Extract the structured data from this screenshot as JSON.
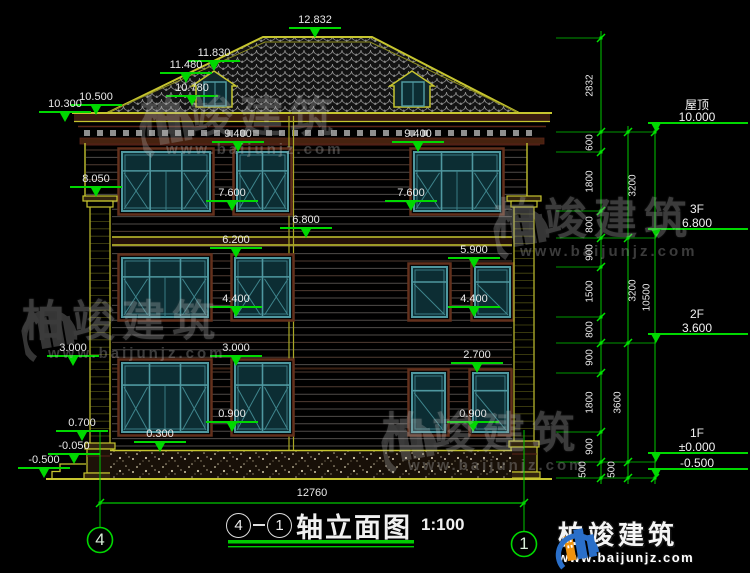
{
  "colors": {
    "green": "#00d800",
    "yellow": "#c6c52f",
    "teal": "#4f98a0",
    "trim_brown": "#63301c",
    "white": "#e9e9e9",
    "logo_blue": "#2a6fc9",
    "logo_orange": "#f0920e",
    "watermark_gray": "#b4b4b4"
  },
  "title": {
    "axis_start": "4",
    "axis_end": "1",
    "text": "轴立面图",
    "scale": "1:100"
  },
  "bottom_dimension": "12760",
  "axes": [
    {
      "label": "4"
    },
    {
      "label": "1"
    }
  ],
  "floor_markers": [
    {
      "name": "屋顶",
      "value": "10.000",
      "y": 132
    },
    {
      "name": "3F",
      "value": "6.800",
      "y": 238
    },
    {
      "name": "2F",
      "value": "3.600",
      "y": 343
    },
    {
      "name": "1F",
      "value": "±0.000",
      "y": 462
    },
    {
      "name": "",
      "value": "-0.500",
      "y": 478
    }
  ],
  "level_markers": [
    {
      "label": "12.832",
      "x": 315,
      "y": 38
    },
    {
      "label": "11.830",
      "x": 214,
      "y": 71
    },
    {
      "label": "11.480",
      "x": 186,
      "y": 83
    },
    {
      "label": "10.780",
      "x": 192,
      "y": 106
    },
    {
      "label": "10.500",
      "x": 96,
      "y": 115
    },
    {
      "label": "10.300",
      "x": 65,
      "y": 122
    },
    {
      "label": "9.400",
      "x": 238,
      "y": 152
    },
    {
      "label": "9.400",
      "x": 418,
      "y": 152
    },
    {
      "label": "8.050",
      "x": 96,
      "y": 197
    },
    {
      "label": "7.600",
      "x": 232,
      "y": 211
    },
    {
      "label": "7.600",
      "x": 411,
      "y": 211
    },
    {
      "label": "6.800",
      "x": 306,
      "y": 238
    },
    {
      "label": "6.200",
      "x": 236,
      "y": 258
    },
    {
      "label": "5.900",
      "x": 474,
      "y": 268
    },
    {
      "label": "4.400",
      "x": 236,
      "y": 317
    },
    {
      "label": "4.400",
      "x": 474,
      "y": 317
    },
    {
      "label": "3.000",
      "x": 73,
      "y": 366
    },
    {
      "label": "3.000",
      "x": 236,
      "y": 366
    },
    {
      "label": "2.700",
      "x": 477,
      "y": 373
    },
    {
      "label": "0.900",
      "x": 232,
      "y": 432
    },
    {
      "label": "0.900",
      "x": 473,
      "y": 432
    },
    {
      "label": "0.700",
      "x": 82,
      "y": 441
    },
    {
      "label": "0.300",
      "x": 160,
      "y": 452
    },
    {
      "label": "-0.050",
      "x": 74,
      "y": 464
    },
    {
      "label": "-0.500",
      "x": 44,
      "y": 478
    }
  ],
  "chain_labels": [
    {
      "t": "2832",
      "x": 590,
      "y": 86
    },
    {
      "t": "600",
      "x": 590,
      "y": 143
    },
    {
      "t": "1800",
      "x": 590,
      "y": 182
    },
    {
      "t": "800",
      "x": 590,
      "y": 225
    },
    {
      "t": "900",
      "x": 590,
      "y": 253
    },
    {
      "t": "1500",
      "x": 590,
      "y": 292
    },
    {
      "t": "800",
      "x": 590,
      "y": 330
    },
    {
      "t": "900",
      "x": 590,
      "y": 358
    },
    {
      "t": "1800",
      "x": 590,
      "y": 403
    },
    {
      "t": "900",
      "x": 590,
      "y": 447
    },
    {
      "t": "500",
      "x": 583,
      "y": 470
    },
    {
      "t": "3200",
      "x": 633,
      "y": 186
    },
    {
      "t": "3200",
      "x": 633,
      "y": 291
    },
    {
      "t": "3600",
      "x": 618,
      "y": 403
    },
    {
      "t": "500",
      "x": 612,
      "y": 470
    },
    {
      "t": "10500",
      "x": 647,
      "y": 298
    }
  ],
  "watermark": {
    "text": "柏竣建筑",
    "url": "www.baijunjz.com",
    "positions": [
      {
        "x": 140,
        "y": 96
      },
      {
        "x": 22,
        "y": 300
      },
      {
        "x": 494,
        "y": 198
      },
      {
        "x": 382,
        "y": 412
      }
    ]
  },
  "logo": {
    "text": "柏竣建筑",
    "url": "www.baijunjz.com"
  }
}
